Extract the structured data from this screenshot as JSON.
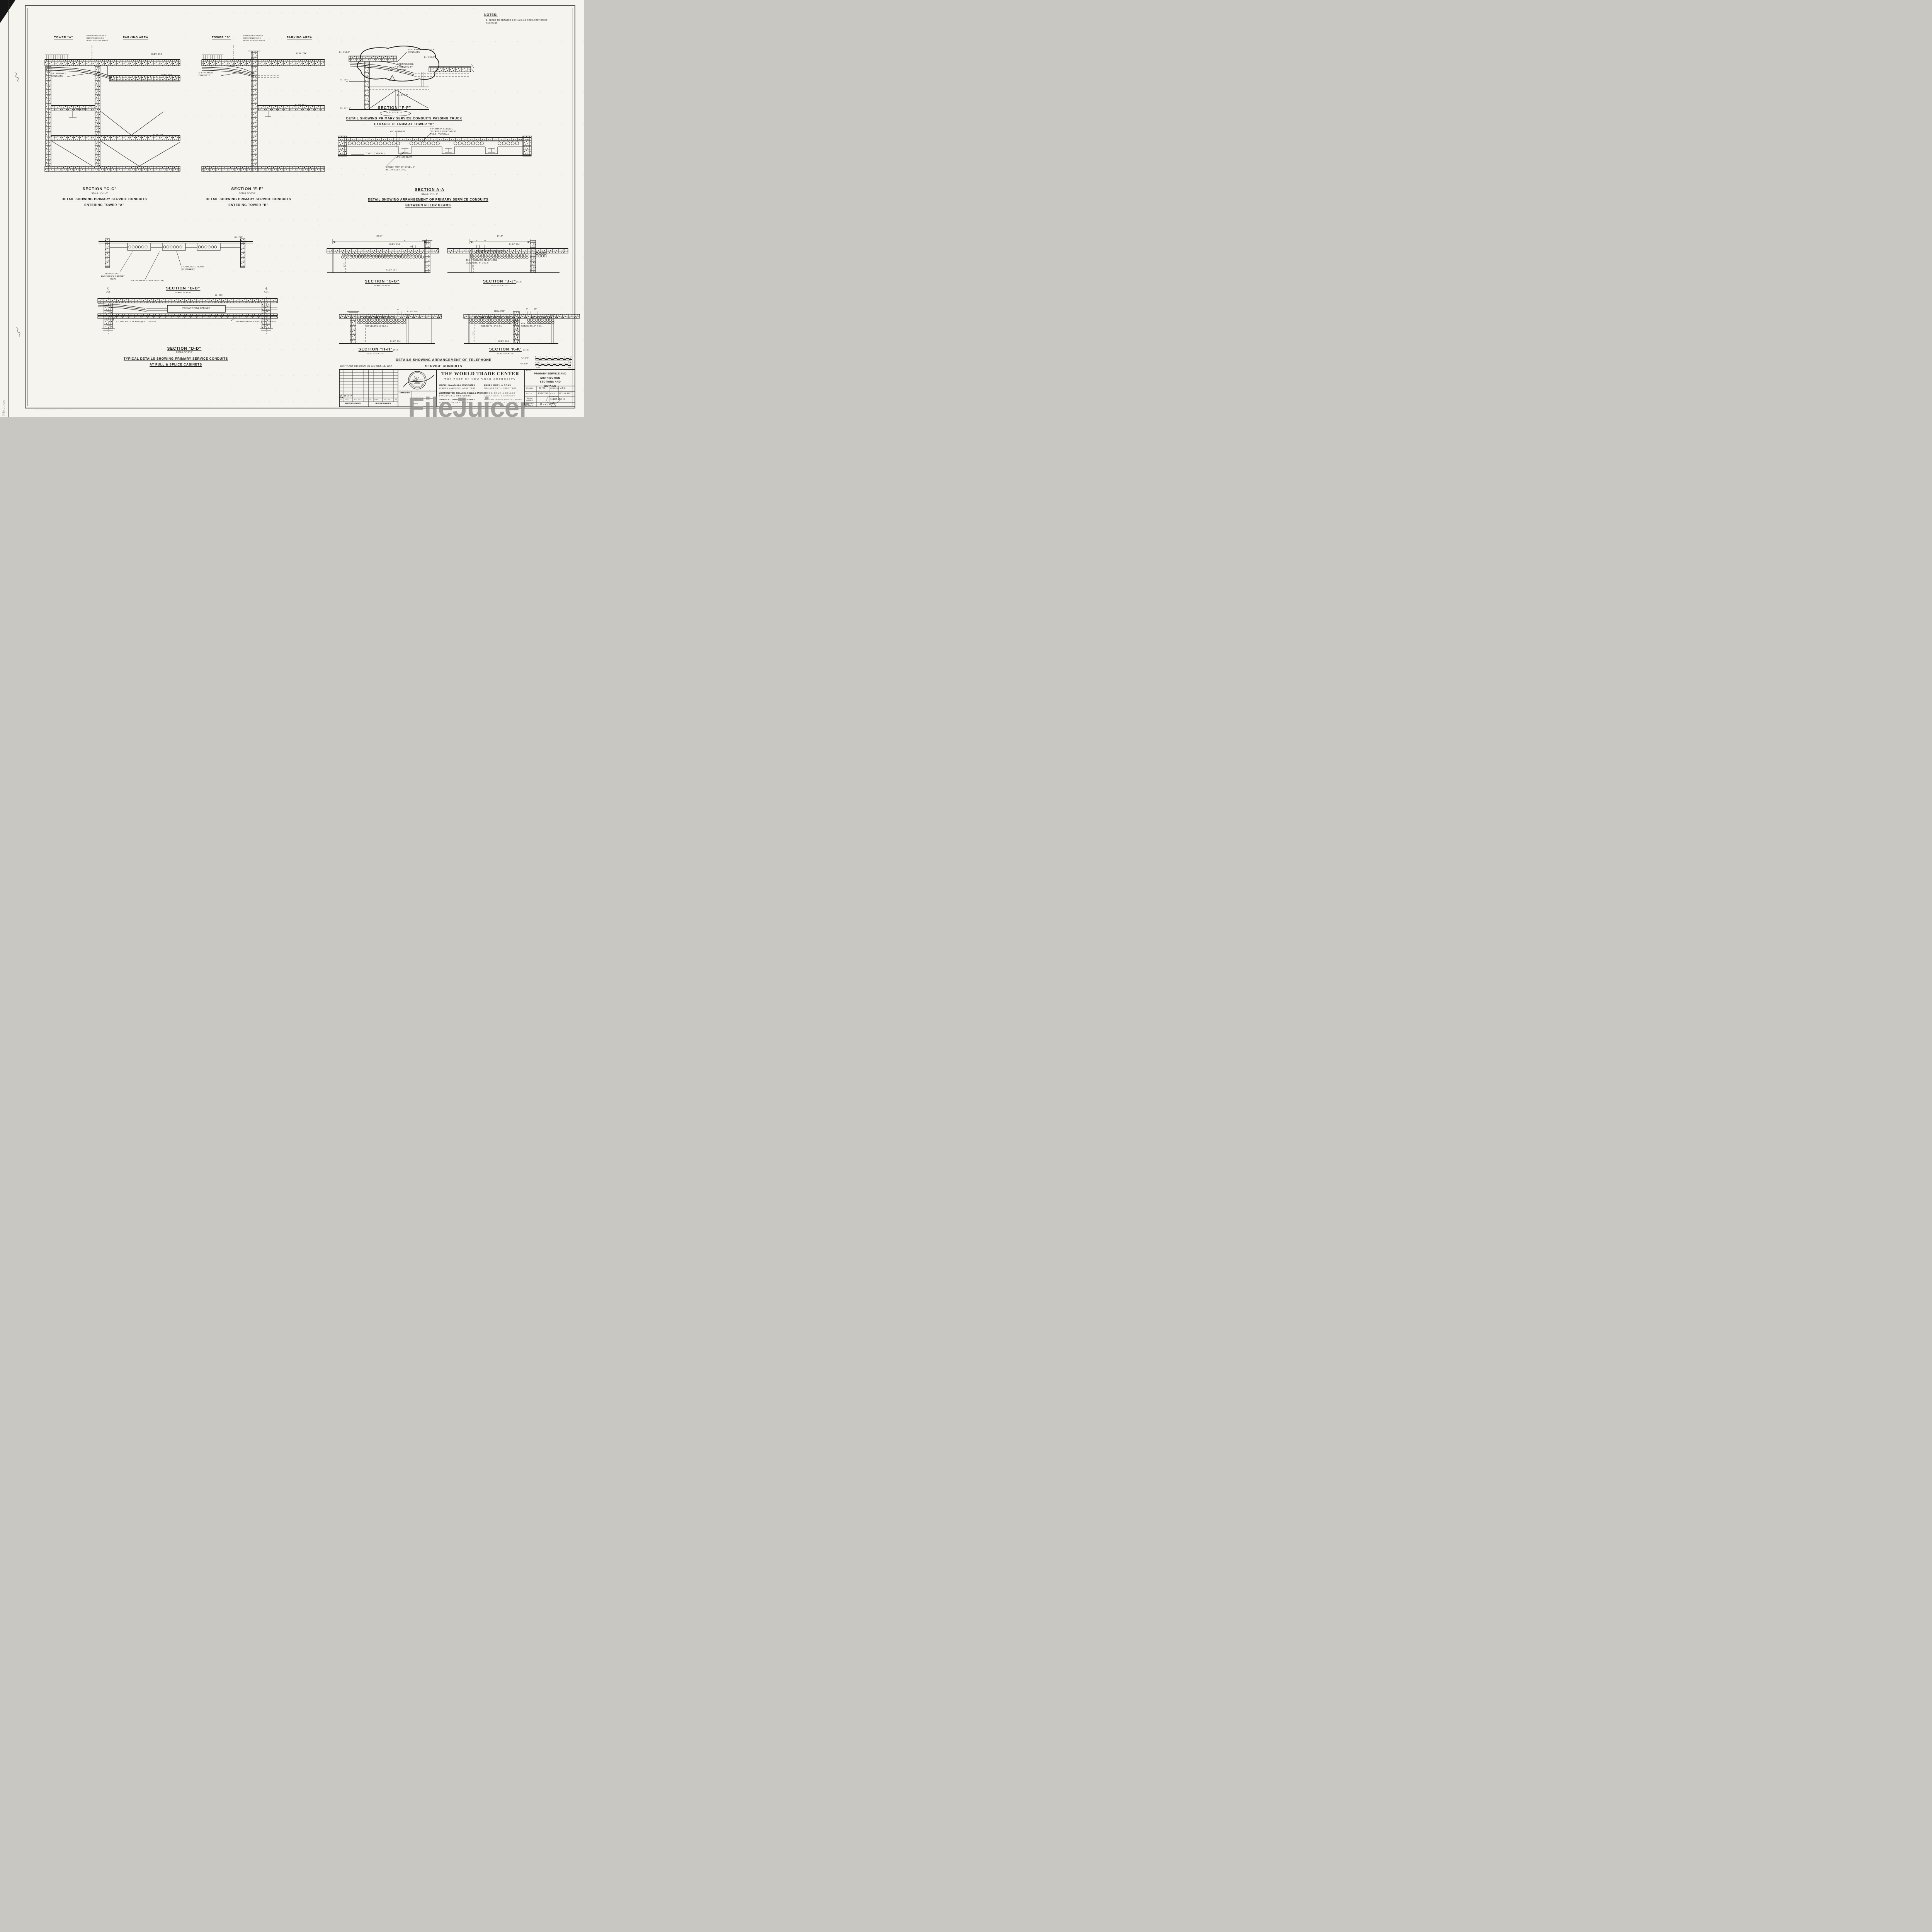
{
  "notes": {
    "title": "NOTES:",
    "item": "1. REFER TO DRAWING E-X-1 & E-X-2  FOR LOCATION OF\n    SECTIONS."
  },
  "cc": {
    "tower": "TOWER \"A\"",
    "extcol": "EXTERIOR COLUMN\nREFERENCE LINE\n(EAST SIDE OF BLDG)",
    "parking": "PARKING AREA",
    "elev294": "ELEV. 294'",
    "elev290": "ELEV. 290'",
    "elev284": "ELEV. 284'",
    "elev274": "ELEV. 274'",
    "conduits": "5-4\" PRIMARY\nCONDUITS",
    "title": "SECTION \"C-C\"",
    "scale": "SCALE: ½\"=1'-0\"",
    "cap1": "DETAIL SHOWING PRIMARY SERVICE CONDUITS",
    "cap2": "ENTERING TOWER \"A\""
  },
  "ee": {
    "tower": "TOWER \"B\"",
    "extcol": "EXTERIOR COLUMN\nREFERENCE LINE\n(EAST SIDE OF BLDG)",
    "parking": "PARKING AREA",
    "elev294": "ELEV. 294'",
    "elev284": "ELEV. 284'",
    "conduits": "6-4\" PRIMARY\nCONDUITS",
    "title": "SECTION 'E-E'",
    "scale": "SCALE: ½\"=1'-0\"",
    "cap1": "DETAIL SHOWING PRIMARY SERVICE CONDUITS",
    "cap2": "ENTERING TOWER \"B\""
  },
  "ff": {
    "el294": "EL. 294'-0\"",
    "el290": "EL. 290'-0\"",
    "el284": "EL. 284'-0\"",
    "el279": "EL. 279'-3\"",
    "el274": "EL. 274'-0\"",
    "conduits": "15-4\" PRIMARY SERVICE\nCONDUITS.",
    "sprayed": "SPRAYED FIRE-\nPROOFING BY\nOTHERS",
    "rev": "1",
    "title": "SECTION \"F-F\"",
    "scale": "SCALE: ¼\"=1'-0\"",
    "cap1": "DETAIL SHOWING PRIMARY SERVICE CONDUITS PASSING TRUCK",
    "cap2": "EXHAUST PLENUM AT TOWER \"B\""
  },
  "aa": {
    "dist": "4\" PRIMARY SERVICE\nDISTRIBUTION CONDUIT\n7\" O.C. (TYPICAL)",
    "min": "4½\" MINIMUM",
    "oc": "7\" O.C. (TYPICAL)",
    "filler": "FILLER BEAM",
    "girder": "GIRDER (TOP OF STEEL -9\"\nBELOW ELEV. 290')",
    "elev290": "ELEV. 290'",
    "title": "SECTION A-A",
    "scale": "SCALE: ½\"=1'-0\"",
    "cap1": "DETAIL SHOWING ARRANGEMENT OF PRIMARY SERVICE CONDUITS",
    "cap2": "BETWEEN FILLER BEAMS"
  },
  "bb": {
    "el290": "EL. 290'",
    "pull": "PRIMARY PULL\nAND SPLICE CABINET\n(TYP)",
    "plank": "2\" CONCRETE PLANK\n(BY OTHERS)",
    "conduits": "5-4\" PRIMARY CONDUITS (TYP)",
    "title": "SECTION \"B-B\"",
    "scale": "SCALE: ½\"=1'-0\""
  },
  "dd": {
    "cl": "℄",
    "col": "COL",
    "el290": "EL. 290'",
    "cabinet": "PRIMARY PULL CABINET",
    "planks": "2\" CONCRETE PLANKS (BY OTHERS)",
    "fireproof": "BEAM FIREPROOFING (BY OTHERS)",
    "title": "SECTION \"D-D\"",
    "scale": "SCALE: ½\"=1'-0\"",
    "cap1": "TYPICAL DETAILS SHOWING PRIMARY SERVICE CONDUITS",
    "cap2": "AT PULL & SPLICE CABINETS"
  },
  "gg": {
    "dim": "30'-0\"",
    "elev294": "ELEV. 294'",
    "d6": "6\"",
    "conduits": "96-4\" SERVICE TELEPHONE CONDUITS-6\" O.C.±",
    "vdim": "8'-1\"",
    "elev284": "ELEV. 284'",
    "title": "SECTION \"G-G\"",
    "scale": "SCALE: ¼\"=1'-0\""
  },
  "jj": {
    "dim": "21'-0\"",
    "d6": "6\"",
    "d10": "10\"",
    "elev294": "ELEV. 294'",
    "conduits": "120-4\" SERVICE TELEPHONE\nCONDUITS -6\" O.C. ±",
    "vdim": "7'-8\"",
    "title": "SECTION \"J-J\"",
    "nic": "(N.I.C.)",
    "scale": "SCALE: ¼\"=1'-0\""
  },
  "hh": {
    "d6": "6\"",
    "elev294": "ELEV. 294'",
    "conduits": "96-4\" SERVICE TELEPHONE\nCONDUITS -6\" O.C.±",
    "elev284": "ELEV. 284'",
    "title": "SECTION \"H-H\"",
    "nic": "(N.I.C.)",
    "scale": "SCALE: ¼\"=1'-0\""
  },
  "kk": {
    "elev294": "ELEV. 294'",
    "d6": "6\"",
    "d10": "10\"",
    "left": "79-4\" SERVICE TELEPHONE\nCONDUITS -6\" O.C.±",
    "right": "41-4\" SERVICE TELEPHONE\nCONDUITS -6\" O.C.±",
    "vdim": "7'-0\"",
    "elev284": "ELEV. 284'",
    "title": "SECTION 'K-K'",
    "nic": "(N.I.C.)",
    "scale": "SCALE: ¼\"=1'-0\""
  },
  "tel": {
    "cap1": "DETAILS SHOWING ARRANGEMENT OF TELEPHONE",
    "cap2": "SERVICE CONDUITS"
  },
  "tb": {
    "contract": "CONTRACT  BID  DRAWING   date  OCT. 16, 1967",
    "rev": {
      "no": "NO.",
      "date": "DATE",
      "bul": "BUL. NO.",
      "by": "BY",
      "label": "REVISIONS",
      "entry_no": "1",
      "entry_date": "12-18-67"
    },
    "approved": "APPROVED",
    "chief": "CHIEF, PLANNING DIVISION",
    "date_word": "DATE",
    "project": "THE WORLD TRADE CENTER",
    "authority": "THE PORT OF NEW YORK AUTHORITY",
    "firms": [
      {
        "name": "MINORU YAMASAKI & ASSOCIATES",
        "role": "MINORU YAMASAKI, ARCHITECT"
      },
      {
        "name": "EMERY ROTH & SONS",
        "role": "RICHARD ROTH, ARCHITECT"
      },
      {
        "name": "WORTHINGTON, SKILLING, HELLE & JACKSON",
        "role": "STRUCTURAL ENGINEERS"
      },
      {
        "name": "JAROS, BAUM & BOLLES",
        "role": "MECHANICAL ENGINEERS"
      },
      {
        "name": "JOSEPH R. LORING & ASSOCIATES",
        "role": "ELECTRICAL ENGINEERS"
      },
      {
        "name": "THE PORT OF NEW YORK AUTHORITY",
        "role": "PAVING, UTILITIES, FOUNDATIONS"
      }
    ],
    "title_label": "TITLE",
    "title": "PRIMARY SERVICE AND\nDISTRIBUTION SECTIONS AND\nDETAILS",
    "drawn_label": "DRAWN",
    "drawn": "R.F.H.",
    "checked_label": "CHECKED",
    "checked": "J.R.L.",
    "scale_label": "SCALE",
    "scale": "AS NOTED",
    "date_label": "DATE",
    "date": "OCT. 16, 1967",
    "project_label": "PROJECT\nNUMBER",
    "sheet": "SHEET 4",
    "of": "OF 12",
    "drawing_label": "DRAWING\nNUMBER",
    "drawing_no": "E-X-4",
    "rev_marker": "1"
  },
  "scalebars": [
    {
      "ratio": "¼\"= 1'0\"",
      "ticks": [
        "2",
        "0",
        "2",
        "4",
        "6",
        "8",
        "10"
      ],
      "left": "scale",
      "right": "feet"
    },
    {
      "ratio": "½\"=1'-0\"",
      "ticks": [
        "0",
        "6\"",
        "1'",
        "2'",
        "3'",
        "4'",
        "5'",
        "6'"
      ],
      "left": "scale",
      "right": "feet"
    }
  ],
  "seal": {
    "top": "LICENSED PROFESSIONAL",
    "name": "JOSEPH R. LORING",
    "bottom": "STATE OF NEW YORK"
  },
  "watermark": "FileJuicer",
  "watermark_side": "File Juicer"
}
